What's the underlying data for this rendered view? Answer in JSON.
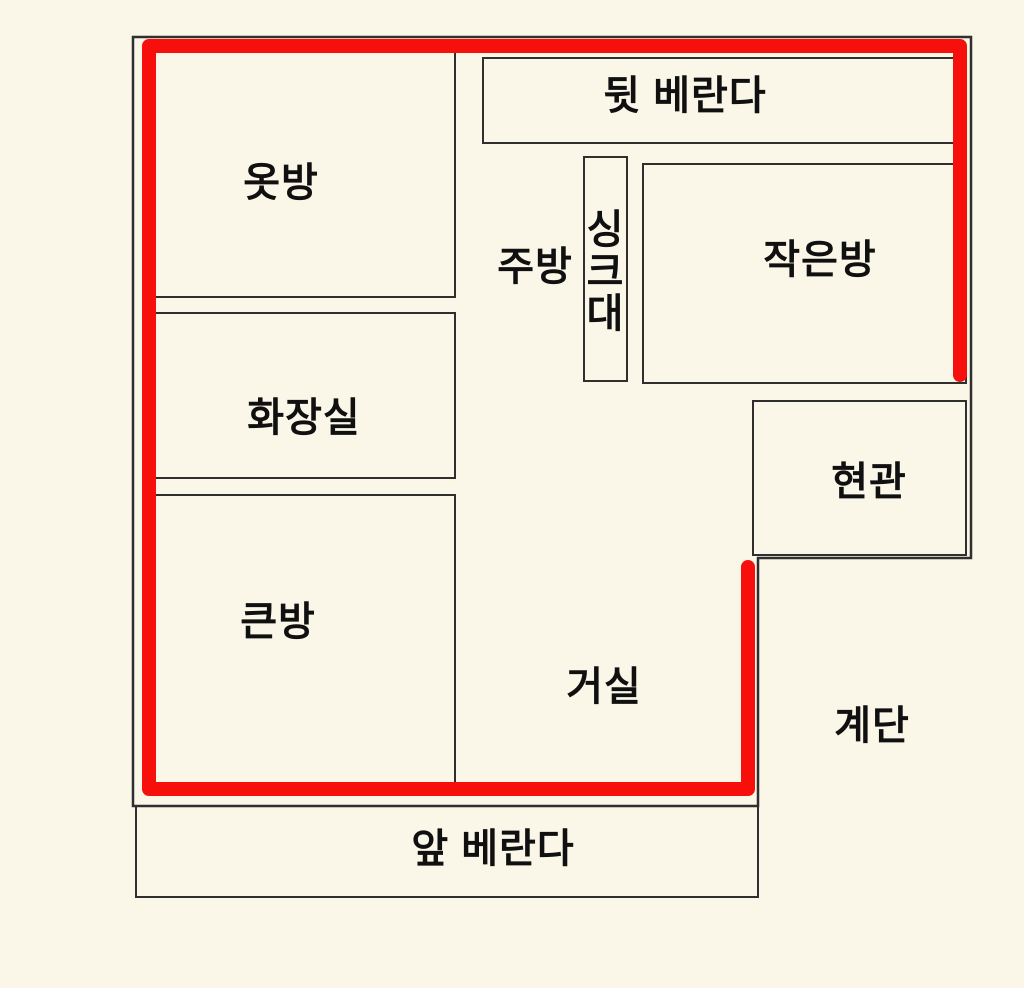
{
  "colors": {
    "background": "#faf7e9",
    "wall_line": "#2f2f2f",
    "route_red": "#f7100b",
    "text": "#101010"
  },
  "floorplan": {
    "rooms": [
      {
        "id": "dressing-room",
        "label": "옷방"
      },
      {
        "id": "back-veranda",
        "label": "뒷 베란다"
      },
      {
        "id": "kitchen",
        "label": "주방"
      },
      {
        "id": "sink",
        "label": "싱크대"
      },
      {
        "id": "small-room",
        "label": "작은방"
      },
      {
        "id": "bathroom",
        "label": "화장실"
      },
      {
        "id": "entrance",
        "label": "현관"
      },
      {
        "id": "big-room",
        "label": "큰방"
      },
      {
        "id": "living-room",
        "label": "거실"
      },
      {
        "id": "stairs",
        "label": "계단"
      },
      {
        "id": "front-veranda",
        "label": "앞 베란다"
      }
    ]
  }
}
